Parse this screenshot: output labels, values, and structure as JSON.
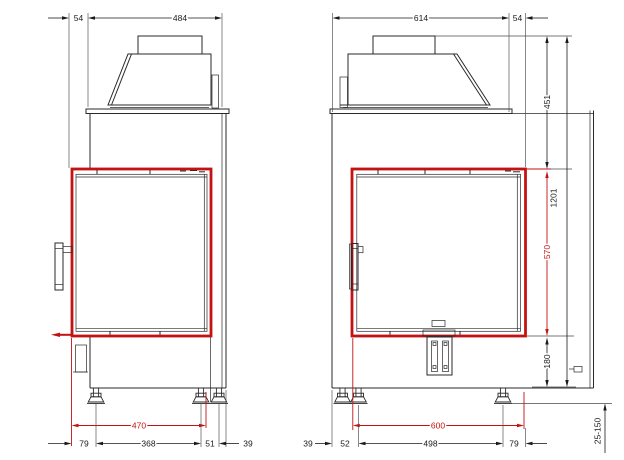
{
  "drawing": {
    "type": "fireplace insert technical drawing, two orthographic views",
    "highlight_color": "#c41212",
    "line_color": "#2a2a2a"
  },
  "side_view": {
    "top_dims": {
      "frame_offset": "54",
      "body_depth": "484"
    },
    "bottom_dims": {
      "glass_depth": "470",
      "front_to_foot": "79",
      "feet_span": "368",
      "rear_feet_gap": "51",
      "rear_edge": "39"
    }
  },
  "front_view": {
    "top_dims": {
      "body_width": "614",
      "frame_overhang": "54"
    },
    "bottom_dims": {
      "left_edge": "39",
      "left_feet_gap": "52",
      "feet_span": "498",
      "right_to_frame": "79",
      "glass_width": "600"
    },
    "right_dims": {
      "hood_height": "451",
      "glass_height": "570",
      "base_height": "180",
      "total_height": "1201",
      "foot_adjust_range": "25-150"
    }
  }
}
